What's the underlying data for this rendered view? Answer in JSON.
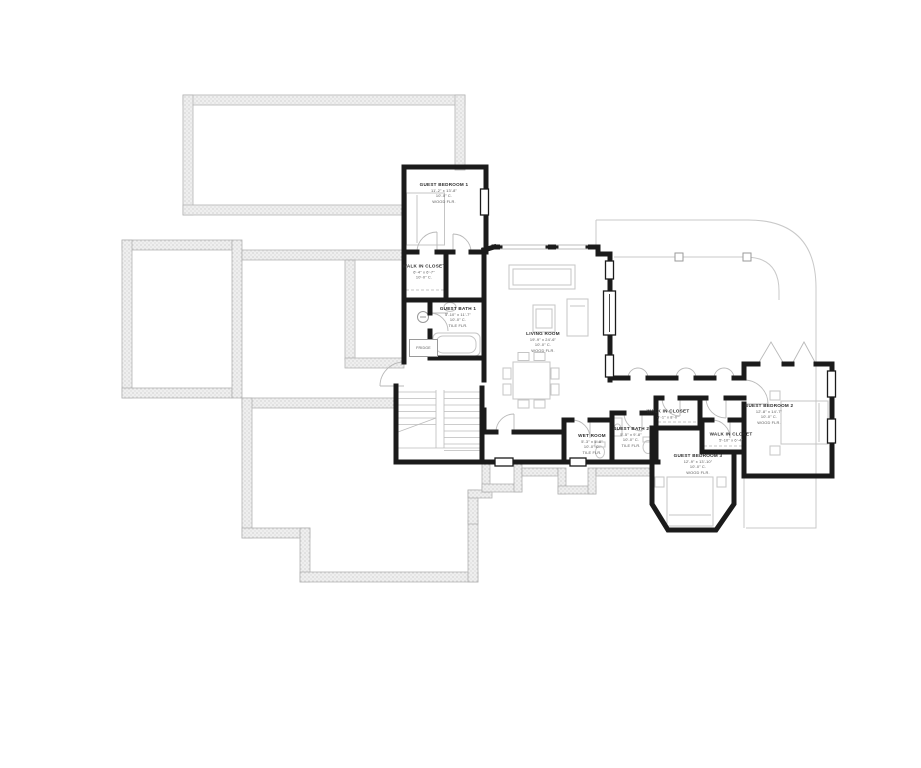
{
  "document": {
    "sheet_type": "lower-level floor plan",
    "background": "#ffffff"
  },
  "colors": {
    "wall": "#1b1b1b",
    "foundation_fill": "#ededed",
    "foundation_edge": "#b4b4b4",
    "thin_line": "#c9c9c9",
    "furniture_line": "#c5c5c5",
    "text": "#4a4a4a"
  },
  "rooms": [
    {
      "id": "guest-bedroom-1",
      "name": "GUEST BEDROOM 1",
      "dims": "11'-2\" x 13'-8\"",
      "ceiling": "10'-0\" C.",
      "floor": "WOOD FLR."
    },
    {
      "id": "walk-in-closet-1",
      "name": "WALK IN CLOSET",
      "dims": "6'-4\" x 6'-7\"",
      "ceiling": "10'-0\" C.",
      "floor": ""
    },
    {
      "id": "guest-bath-1",
      "name": "GUEST BATH 1",
      "dims": "5'-10\" x 11'-7\"",
      "ceiling": "10'-0\" C.",
      "floor": "TILE FLR."
    },
    {
      "id": "living-room",
      "name": "LIVING ROOM",
      "dims": "19'-9\" x 24'-6\"",
      "ceiling": "10'-0\" C.",
      "floor": "WOOD FLR."
    },
    {
      "id": "wet-room",
      "name": "WET ROOM",
      "dims": "5'-3\" x 5'-8\"",
      "ceiling": "10'-0\" C.",
      "floor": "TILE FLR."
    },
    {
      "id": "guest-bath-2",
      "name": "GUEST BATH 2",
      "dims": "5'-5\" x 9'-8\"",
      "ceiling": "10'-0\" C.",
      "floor": "TILE FLR."
    },
    {
      "id": "walk-in-closet-2",
      "name": "WALK IN CLOSET",
      "dims": "4'-1\" x 8'-0\"",
      "ceiling": "",
      "floor": ""
    },
    {
      "id": "guest-bedroom-3",
      "name": "GUEST BEDROOM 3",
      "dims": "12'-9\" x 13'-10\"",
      "ceiling": "10'-0\" C.",
      "floor": "WOOD FLR."
    },
    {
      "id": "walk-in-closet-3",
      "name": "WALK IN CLOSET",
      "dims": "5'-10\" x 6'-4\"",
      "ceiling": "",
      "floor": ""
    },
    {
      "id": "guest-bedroom-2",
      "name": "GUEST BEDROOM 2",
      "dims": "12'-8\" x 14'-7\"",
      "ceiling": "10'-0\" C.",
      "floor": "WOOD FLR."
    }
  ],
  "fixtures": {
    "fridge_label": "FRIDGE"
  }
}
